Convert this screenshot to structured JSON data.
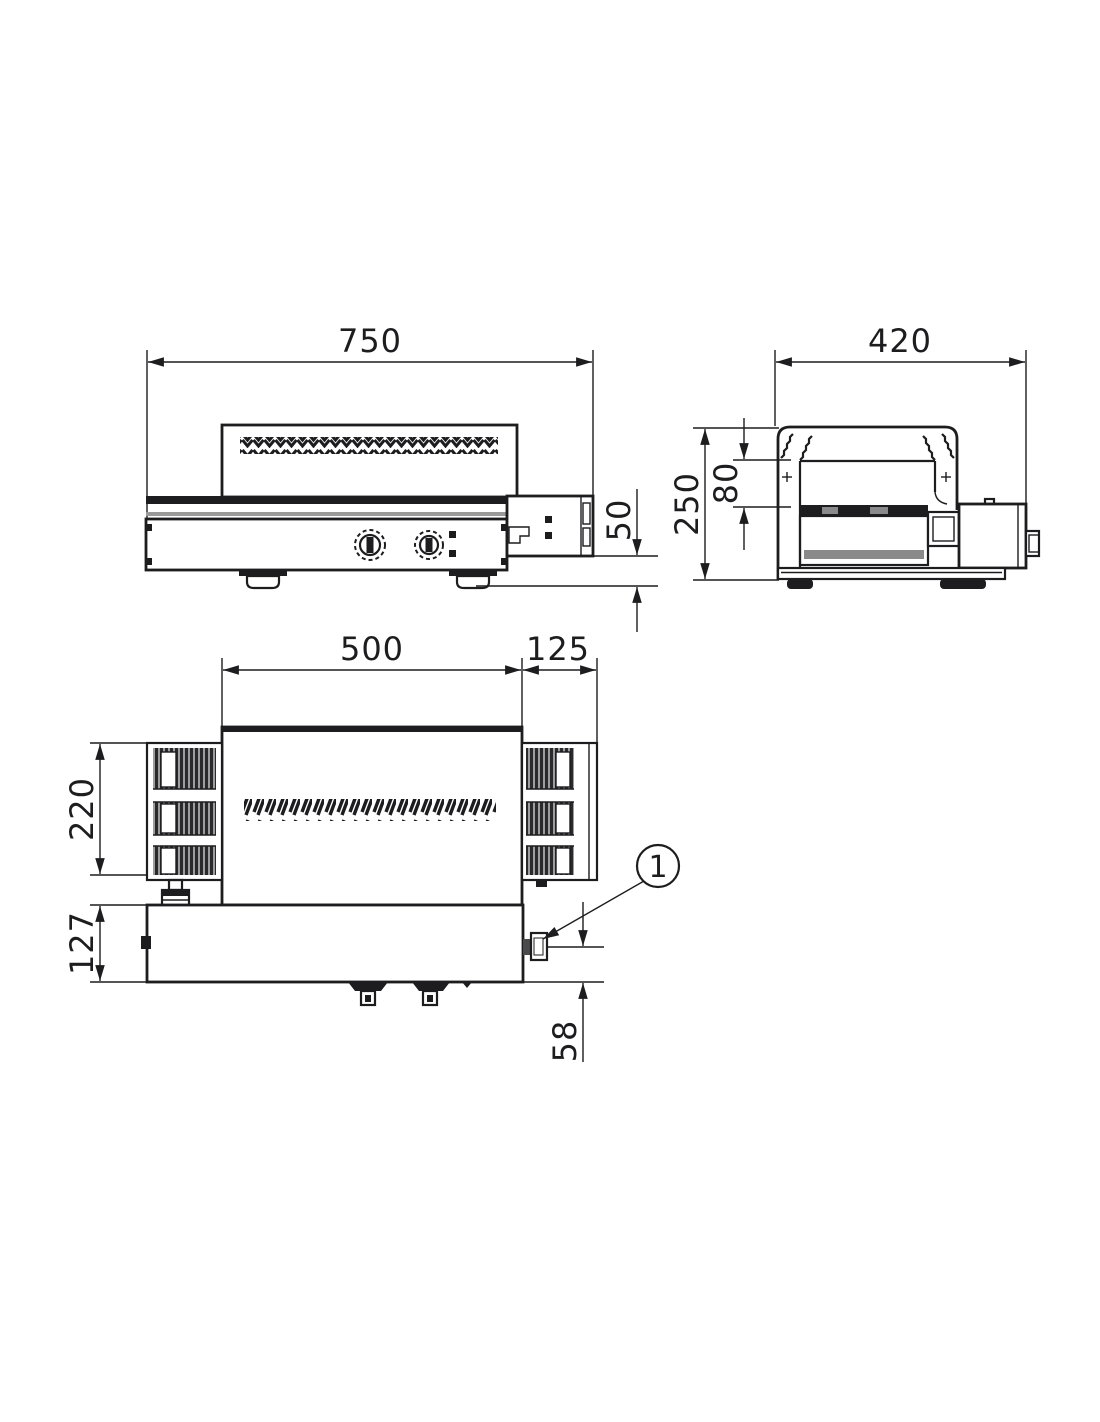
{
  "palette": {
    "ink": "#1d1d1f",
    "paper": "#ffffff"
  },
  "front_view": {
    "dim_overall_width": "750",
    "dim_outfeed_height": "50"
  },
  "side_view": {
    "dim_overall_depth": "420",
    "dim_overall_height": "250",
    "dim_tunnel_opening_height": "80"
  },
  "top_view": {
    "dim_tunnel_length": "500",
    "dim_outfeed_length": "125",
    "dim_belt_width": "220",
    "dim_control_panel_depth": "127",
    "dim_gland_offset": "58"
  },
  "callout": {
    "balloon_1_label": "1"
  }
}
